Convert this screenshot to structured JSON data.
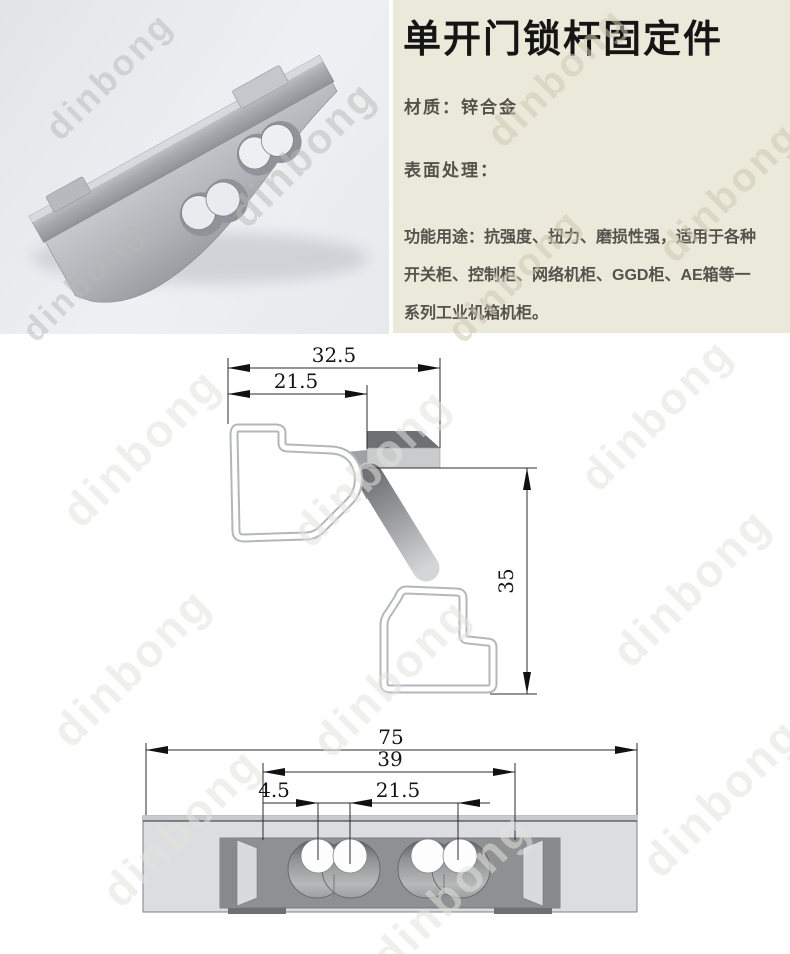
{
  "watermark": {
    "text": "dinbong"
  },
  "product": {
    "title": "单开门锁杆固定件",
    "material": "材质：锌合金",
    "surface": "表面处理：",
    "features": [
      "功能用途：抗强度、扭力、磨损性强，适用于各种",
      "开关柜、控制柜、网络机柜、GGD柜、AE箱等一",
      "系列工业机箱机柜。"
    ]
  },
  "profile_drawing": {
    "dim_top_outer": "32.5",
    "dim_top_inner": "21.5",
    "dim_height": "35"
  },
  "front_drawing": {
    "dim_total_length": "75",
    "dim_mount_span": "39",
    "dim_slot_width": "4.5",
    "dim_hole_spacing": "21.5"
  },
  "colors": {
    "panel_bg": "#ebe9da",
    "title_text": "#151515",
    "body_text": "#54524b",
    "drawing_line": "#2b2b2b",
    "metal_light": "#dcdde0",
    "metal_dark": "#8e9092"
  }
}
